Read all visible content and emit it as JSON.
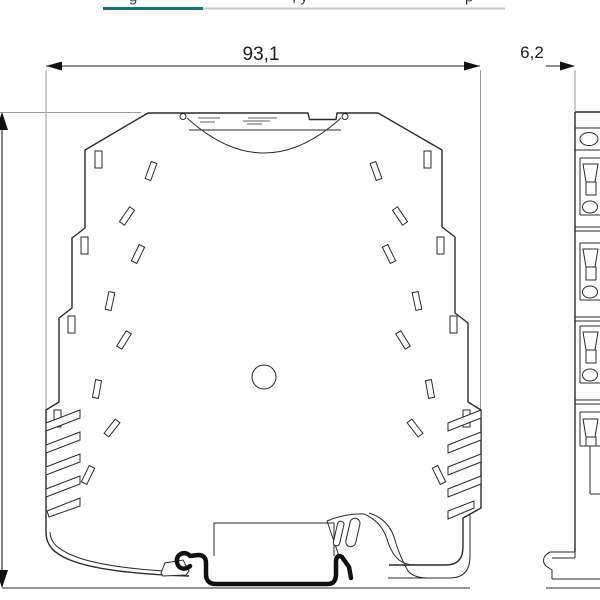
{
  "header": {
    "active_tab_text_fragment": "g",
    "inactive_tab_text_fragment_a": ", y",
    "inactive_tab_text_fragment_b": "p",
    "active_underline_color": "#12737c",
    "inactive_underline_color": "#c9c9c9"
  },
  "drawing": {
    "front_view_width_mm": "93,1",
    "side_view_width_mm": "6,2"
  }
}
